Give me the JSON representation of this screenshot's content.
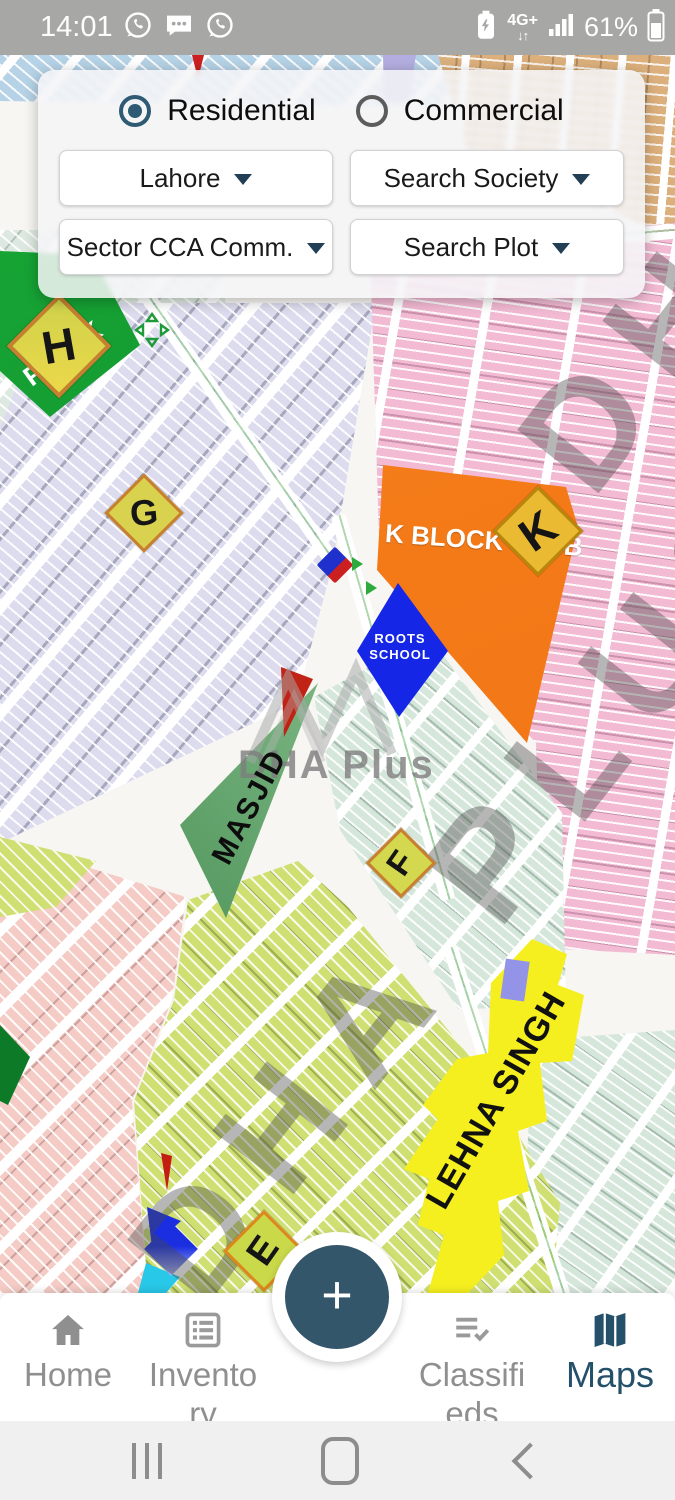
{
  "status_bar": {
    "time": "14:01",
    "network": "4G+",
    "network_arrows": "↓↑",
    "battery_percent": "61%"
  },
  "filter_panel": {
    "radio_options": [
      {
        "label": "Residential",
        "selected": true
      },
      {
        "label": "Commercial",
        "selected": false
      }
    ],
    "dropdowns": [
      {
        "id": "city",
        "value": "Lahore"
      },
      {
        "id": "society",
        "value": "Search Society"
      },
      {
        "id": "sector",
        "value": "Sector CCA Comm."
      },
      {
        "id": "plot",
        "value": "Search Plot"
      }
    ]
  },
  "map": {
    "watermark_text": "DHA PLUS",
    "logo_text": "DHA Plus",
    "labels": {
      "park": "PARK",
      "k_block_club": "K BLOCK CLUB",
      "roots_school_line1": "ROOTS",
      "roots_school_line2": "SCHOOL",
      "masjid": "MASJID",
      "lehna_singh": "LEHNA SINGH"
    },
    "block_badges": [
      {
        "letter": "H"
      },
      {
        "letter": "G"
      },
      {
        "letter": "K"
      },
      {
        "letter": "F"
      },
      {
        "letter": "E"
      }
    ],
    "colors": {
      "accent_teal": "#2e5a74",
      "fab_teal": "#33566b",
      "nav_active_teal": "#24506a",
      "residential_lavender": "#dcdcee",
      "residential_pink": "#f2bad3",
      "residential_mint": "#d5e6db",
      "residential_lime": "#cfdf72",
      "residential_salmon": "#f4cbc5",
      "residential_tan": "#dcb07c",
      "residential_skyblue": "#b5d2e6",
      "park_green": "#0c7a26",
      "club_orange": "#f57b17",
      "school_blue": "#1526e6",
      "lehna_yellow": "#f6ef1f"
    }
  },
  "fab": {
    "label": "+"
  },
  "bottom_nav": {
    "items": [
      {
        "label": "Home",
        "line1": "Home",
        "active": false
      },
      {
        "label": "Inventory",
        "line1": "Invento",
        "line2": "ry",
        "active": false
      },
      {
        "label": "Classifieds",
        "line1": "Classifi",
        "line2": "eds",
        "active": false
      },
      {
        "label": "Maps",
        "line1": "Maps",
        "active": true
      }
    ]
  }
}
